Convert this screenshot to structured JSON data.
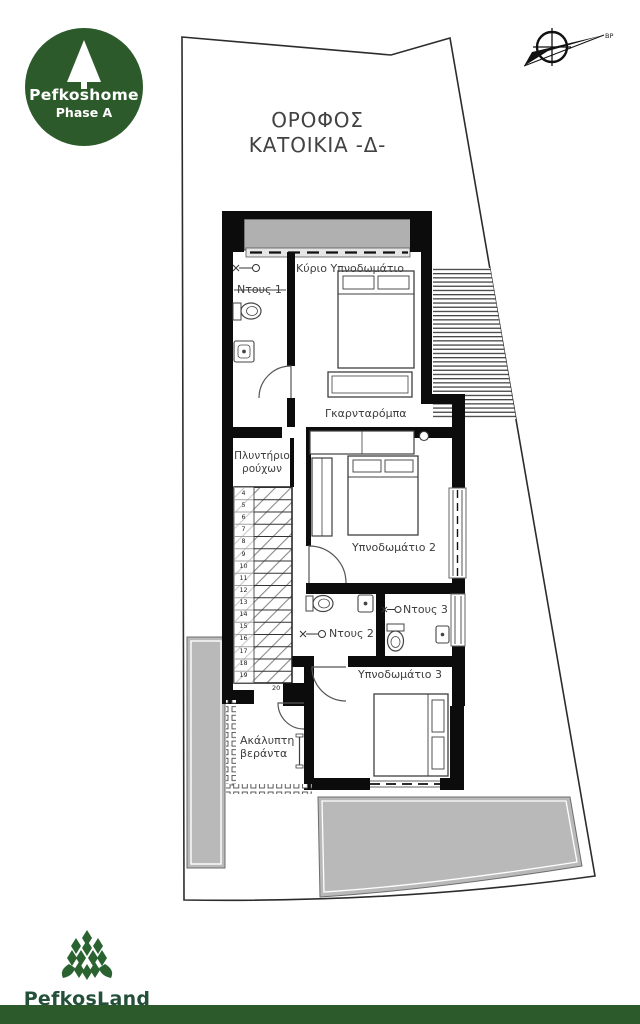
{
  "branding": {
    "logo_top": {
      "name": "Pefkoshome",
      "phase": "Phase A"
    },
    "logo_bottom": {
      "name": "PefkosLand"
    }
  },
  "title": {
    "line1": "ΟΡΟΦΟΣ",
    "line2": "ΚΑΤΟΙΚΙΑ -Δ-"
  },
  "compass": {
    "label": "ΒΡ"
  },
  "plan": {
    "rooms": {
      "shower1": "Ντους 1",
      "master_bedroom": "Κύριο Υπνοδωμάτιο",
      "wardrobe": "Γκαρνταρόμπα",
      "laundry_line1": "Πλυντήριο",
      "laundry_line2": "ρούχων",
      "bedroom2": "Υπνοδωμάτιο 2",
      "shower2": "Ντους 2",
      "shower3": "Ντους 3",
      "bedroom3": "Υπνοδωμάτιο 3",
      "veranda_line1": "Ακάλυπτη",
      "veranda_line2": "βεράντα"
    },
    "stairs": {
      "numbers": [
        "4",
        "5",
        "6",
        "7",
        "8",
        "9",
        "10",
        "11",
        "12",
        "13",
        "14",
        "15",
        "16",
        "17",
        "18",
        "19"
      ],
      "landing": "20"
    }
  },
  "colors": {
    "brand_green": "#2d5a2b",
    "patio_gray": "#b9b9b9",
    "balcony_gray": "#b0b0b0",
    "wall_black": "#0c0c0c",
    "label_gray": "#3d3d3d"
  }
}
